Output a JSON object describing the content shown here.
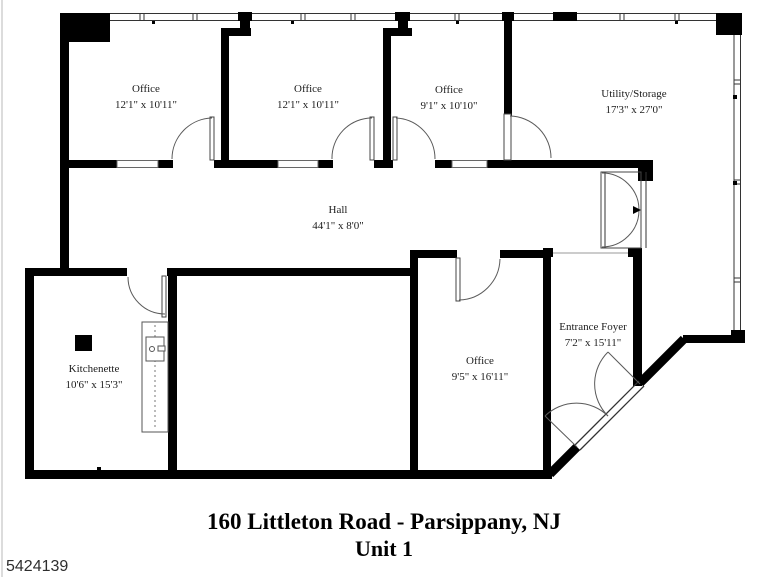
{
  "plan": {
    "rooms": [
      {
        "name": "Office",
        "dims": "12'1\" x 10'11\""
      },
      {
        "name": "Office",
        "dims": "12'1\" x 10'11\""
      },
      {
        "name": "Office",
        "dims": "9'1\" x 10'10\""
      },
      {
        "name": "Utility/Storage",
        "dims": "17'3\" x 27'0\""
      },
      {
        "name": "Hall",
        "dims": "44'1\" x 8'0\""
      },
      {
        "name": "Kitchenette",
        "dims": "10'6\" x 15'3\""
      },
      {
        "name": "Office",
        "dims": "9'5\" x 16'11\""
      },
      {
        "name": "Entrance Foyer",
        "dims": "7'2\" x 15'11\""
      }
    ]
  },
  "footer": {
    "address": "160 Littleton Road - Parsippany, NJ",
    "unit": "Unit 1"
  },
  "watermark": {
    "id": "5424139"
  }
}
